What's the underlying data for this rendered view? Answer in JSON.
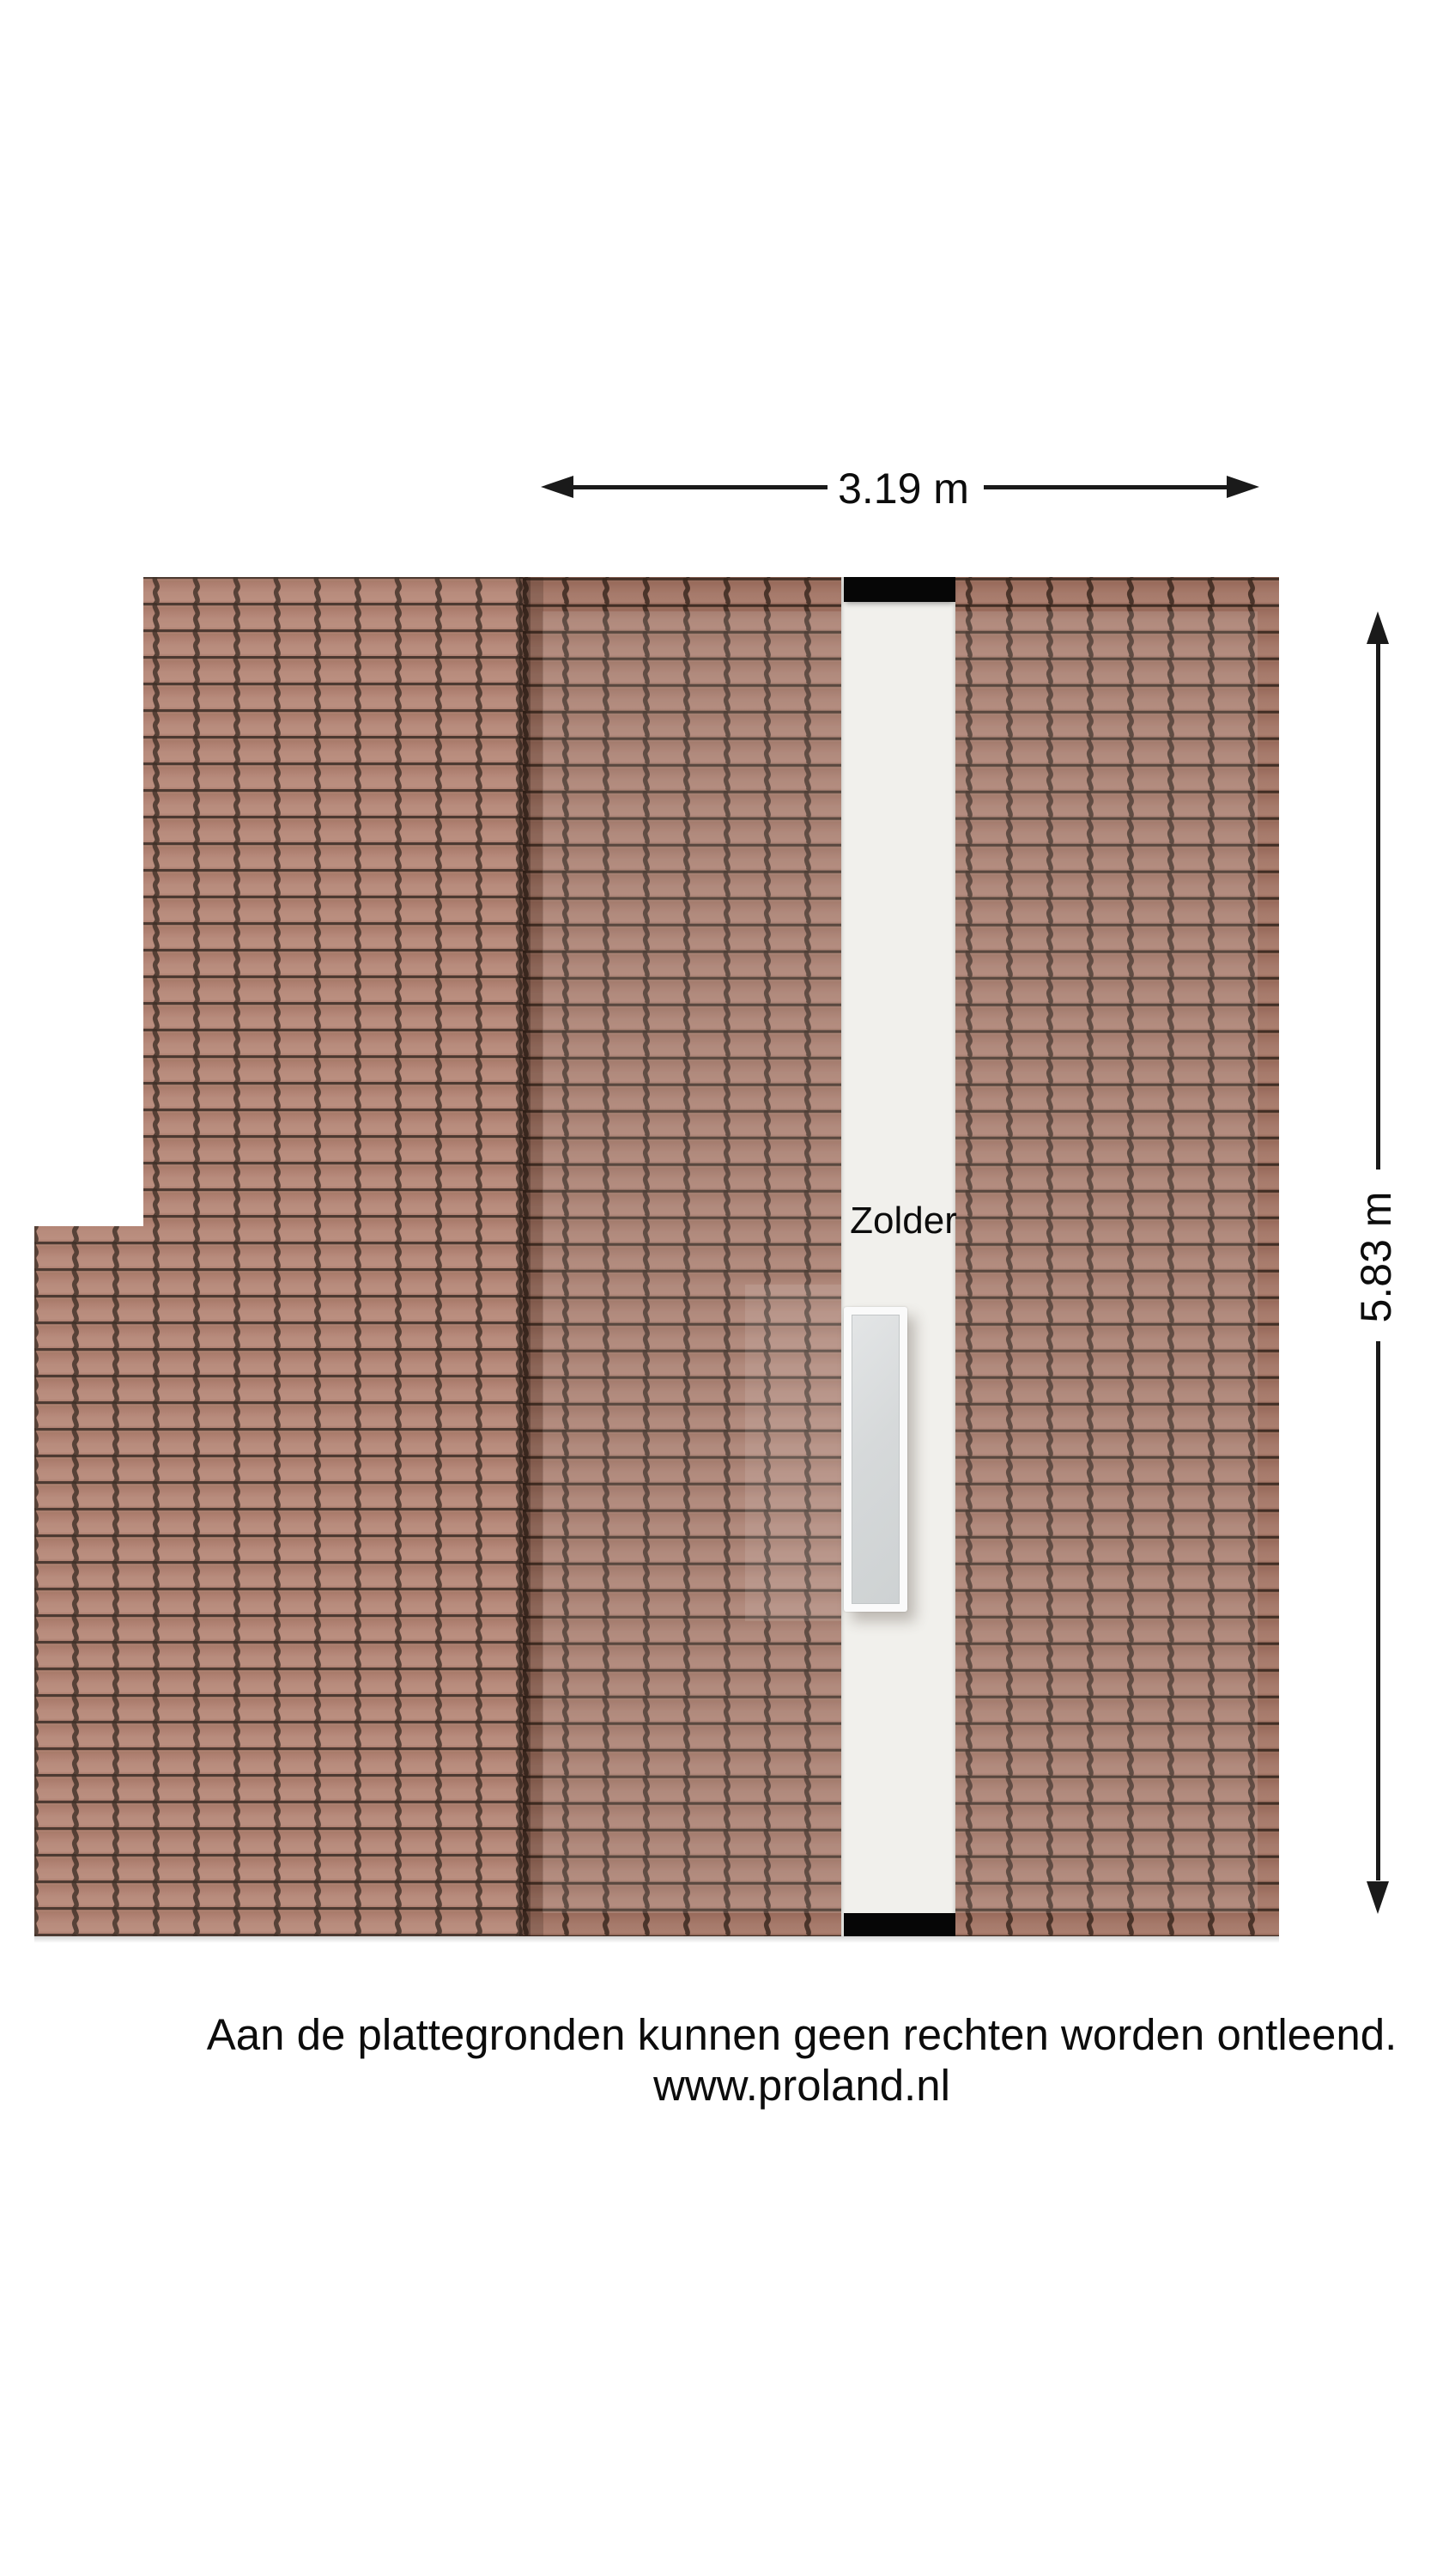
{
  "page": {
    "title": "Zolder plattegrond"
  },
  "floorplan": {
    "room": {
      "label": "Zolder"
    },
    "dimensions": {
      "horizontal": {
        "label": "3.19 m"
      },
      "vertical": {
        "label": "5.83 m"
      }
    },
    "footer": {
      "line1": "Aan de plattegronden kunnen geen rechten worden ontleend.",
      "line2": "www.proland.nl"
    },
    "colors": {
      "page_background": "#ffffff",
      "tile": "#ab7967",
      "tile_groove": "#3a2820",
      "floor": "#f1f0ec",
      "wall": "#060606",
      "window_frame": "#fafafa",
      "window_glass_light": "#e3e5e6",
      "window_glass_dark": "#ced2d3",
      "dimension_line": "#1a1a1a",
      "text": "#111111"
    }
  }
}
